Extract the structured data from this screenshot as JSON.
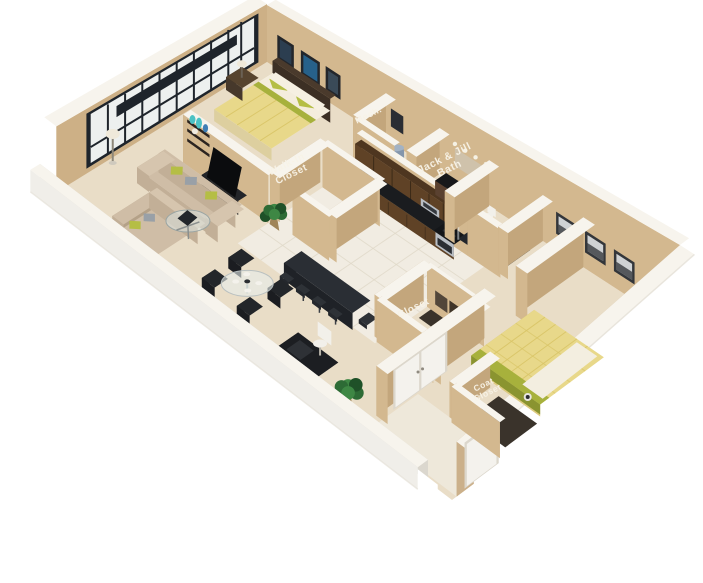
{
  "image_type": "3d-floor-plan-render",
  "labels": {
    "walk_in_closet_line1": "Walk-In",
    "walk_in_closet_line2": "Closet",
    "mech": "Mech.",
    "jack_and_jill_line1": "Jack & Jill",
    "jack_and_jill_line2": "Bath",
    "closet": "Closet",
    "coat_closet_line1": "Coat",
    "coat_closet_line2": "Closet"
  },
  "colors": {
    "wall_tan": "#d3b88f",
    "wall_tan_dark": "#c3a67c",
    "wall_top": "#f7f4ed",
    "white_wall": "#f0eee9",
    "white_wall_inner": "#dbd7ce",
    "carpet": "#e9ddc7",
    "tile": "#f1ece2",
    "cabinet_brown": "#5f4226",
    "cabinet_brown_dark": "#46311b",
    "counter_black": "#1a1c1f",
    "steel": "#b9bec4",
    "sofa_beige": "#cfbda6",
    "sofa_beige_dark": "#b4a188",
    "pillow_green": "#b5be45",
    "pillow_grey": "#99a0a7",
    "dark_furniture": "#1d1f24",
    "bedding_yellow": "#e8d88a",
    "bedding_white": "#f4eddd",
    "accent_green": "#a7b13c",
    "accent_teal": "#4cc2c4",
    "plant_green": "#2d6b35",
    "window_frame": "#1e242b",
    "glass": "#edf0ef",
    "door_white": "#f4f2ed",
    "label_text": "#f8f3e7"
  }
}
